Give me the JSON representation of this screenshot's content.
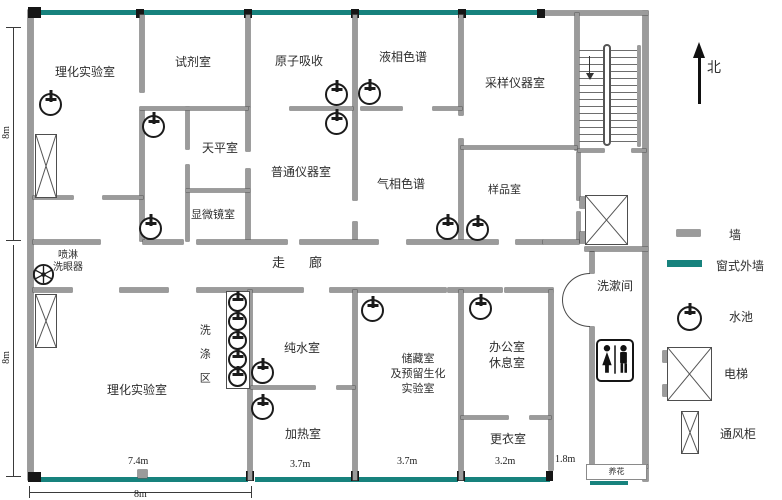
{
  "rooms": {
    "lab_top": "理化实验室",
    "reagent": "试剂室",
    "atomic_absorption": "原子吸收",
    "liquid_chromatography": "液相色谱",
    "sampling_instrument": "采样仪器室",
    "balance": "天平室",
    "general_instrument": "普通仪器室",
    "gas_chromatography": "气相色谱",
    "sample": "样品室",
    "microscope": "显微镜室",
    "corridor": "走廊",
    "washing_area": "洗涤区",
    "pure_water": "纯水室",
    "storage_lines": [
      "储藏室",
      "及预留生化",
      "实验室"
    ],
    "office_lines": [
      "办公室",
      "休息室"
    ],
    "lab_bottom": "理化实验室",
    "heating": "加热室",
    "changing": "更衣室",
    "washroom": "洗漱间",
    "eyewash_lines": [
      "喷淋",
      "洗眼器"
    ],
    "flower": "养花"
  },
  "dimensions": {
    "left_top": "8m",
    "left_bottom": "8m",
    "bottom": "8m",
    "lab_bottom_width": "7.4m",
    "heating_width": "3.7m",
    "storage_width": "3.7m",
    "changing_width": "3.2m",
    "exit_width": "1.8m"
  },
  "compass": {
    "north": "北"
  },
  "legend": {
    "wall": "墙",
    "window_wall": "窗式外墙",
    "sink": "水池",
    "elevator": "电梯",
    "fume_hood": "通风柜"
  },
  "colors": {
    "wall": "#9b9b9b",
    "window_wall": "#17827d",
    "ink": "#1b1b1b"
  }
}
